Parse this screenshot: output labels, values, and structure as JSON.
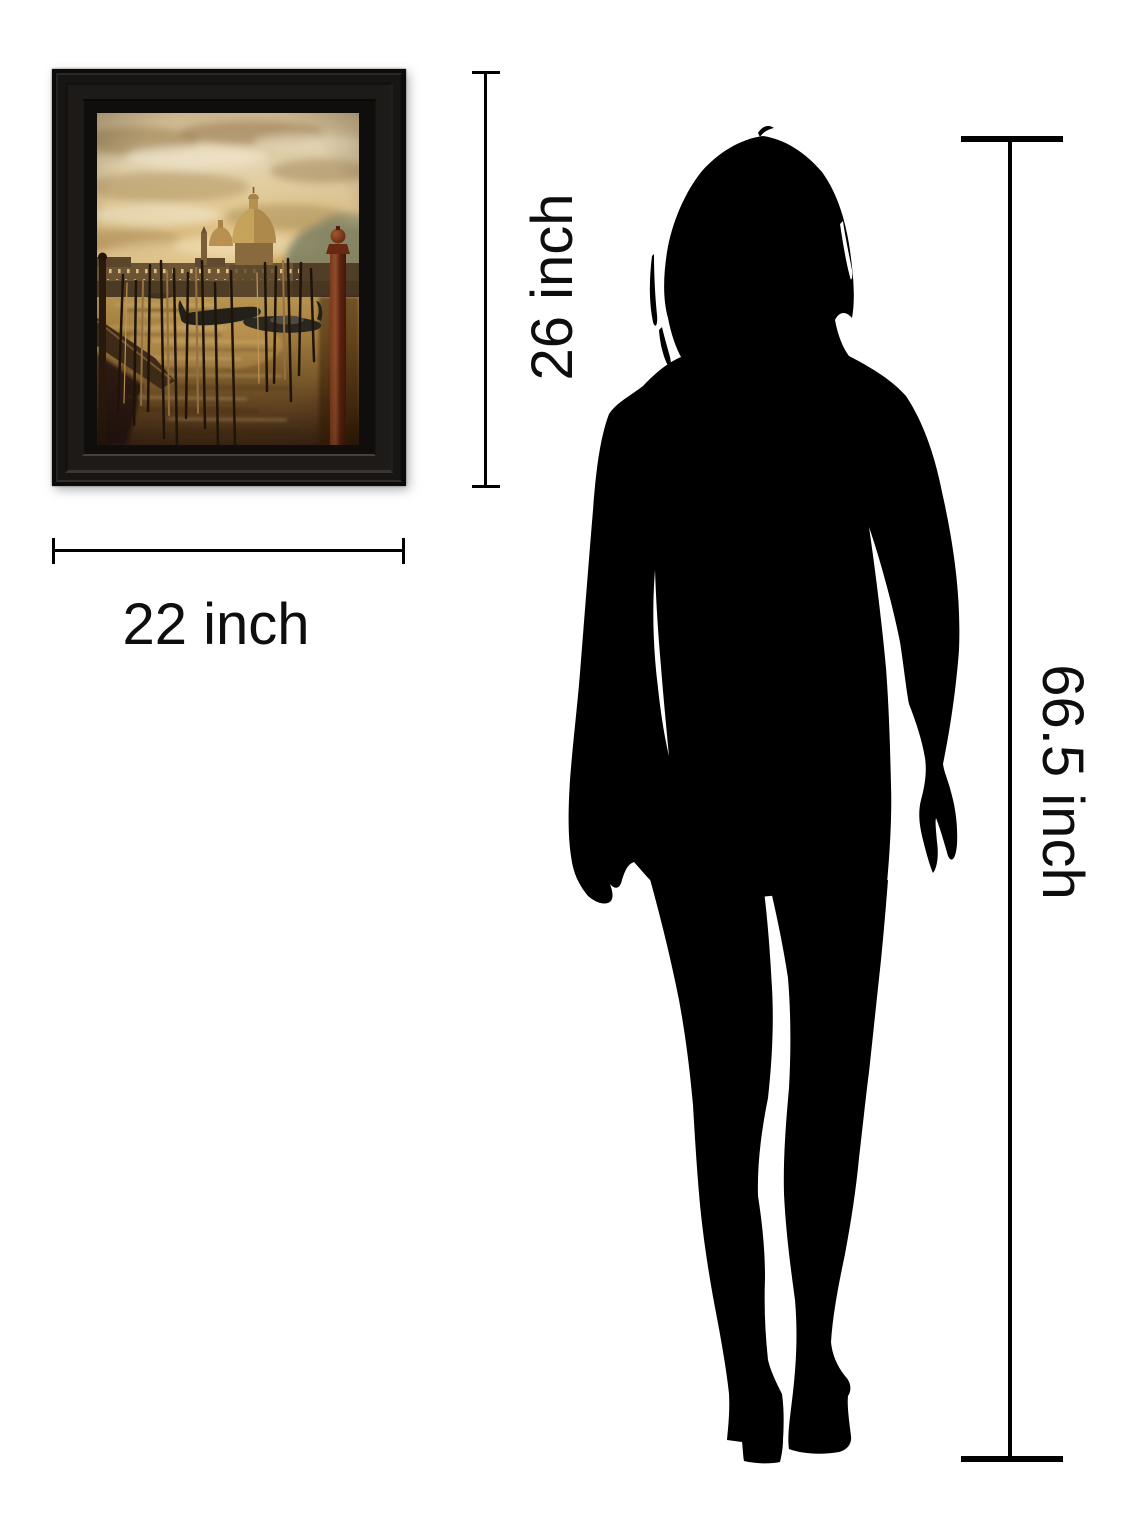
{
  "diagram": {
    "type": "product-size-comparison",
    "frame": {
      "height_label": "26 inch",
      "width_label": "22 inch",
      "artwork_subject": "Venice canal scene with moored gondolas, mooring poles and domed basilica at golden sunset"
    },
    "person": {
      "height_label": "66.5 inch",
      "figure": "woman-silhouette"
    },
    "colors": {
      "background": "#ffffff",
      "lines_and_text": "#000000",
      "silhouette": "#000000",
      "frame_finish": "#181614",
      "art_sky": "#e2cd9e",
      "art_water": "#8a6534",
      "art_pillar": "#6e2a12"
    }
  }
}
